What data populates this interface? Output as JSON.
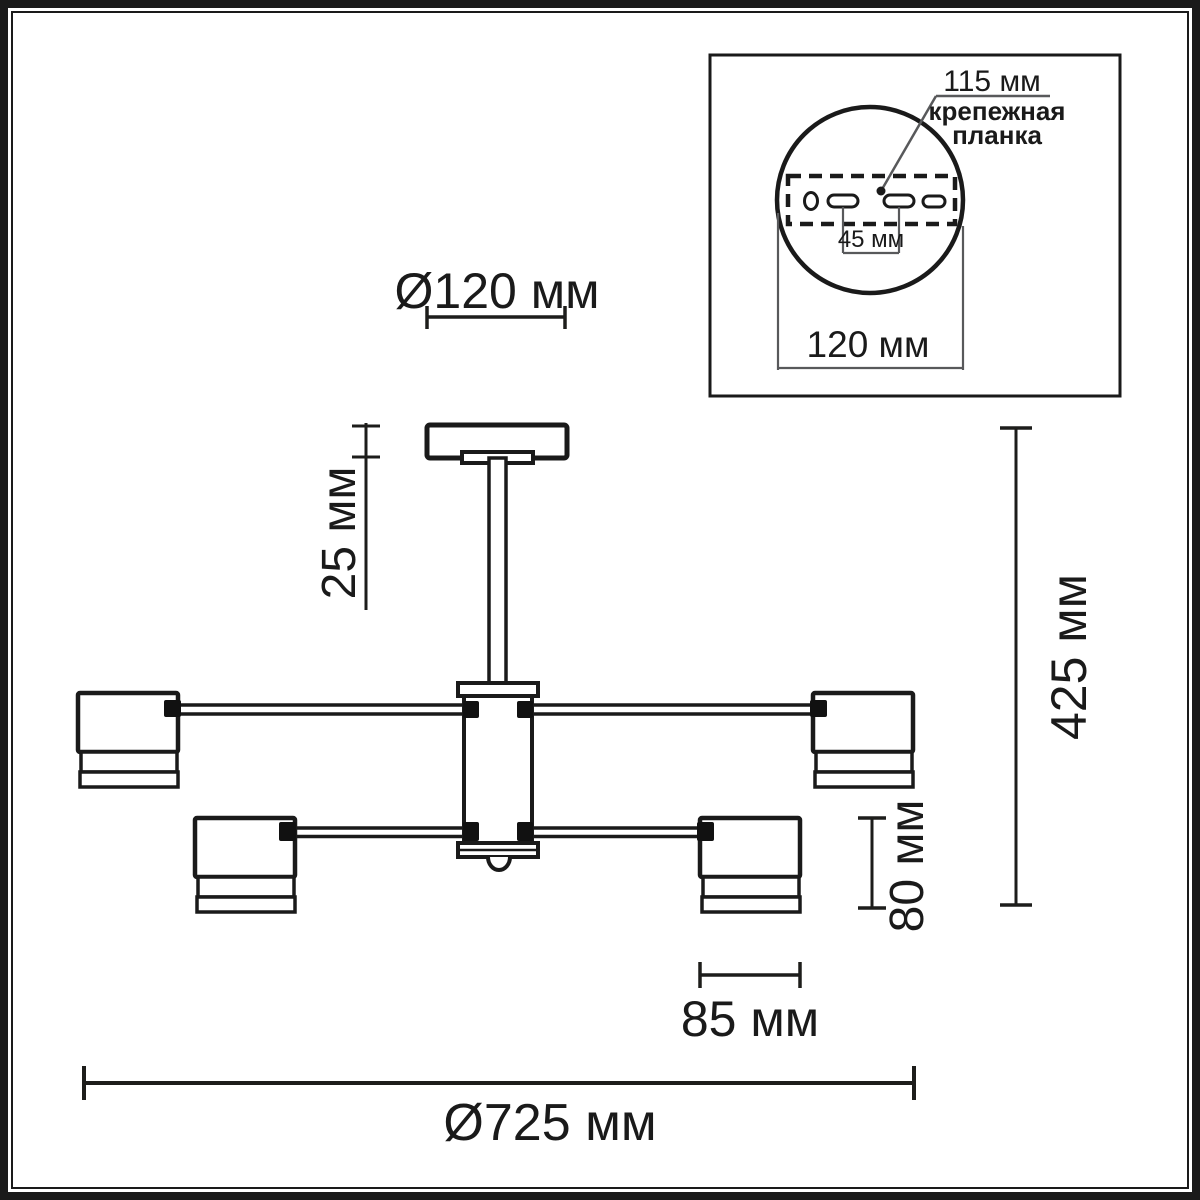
{
  "drawing": {
    "title": "chandelier technical drawing",
    "dimensions": {
      "canopy_diameter": "Ø120 мм",
      "canopy_height": "25 мм",
      "fixture_height": "425 мм",
      "shade_height": "80 мм",
      "shade_diameter": "85 мм",
      "fixture_diameter": "Ø725 мм"
    },
    "inset": {
      "bracket_length": "115 мм",
      "bracket_label_line1": "крепежная",
      "bracket_label_line2": "планка",
      "hole_spacing": "45 мм",
      "base_diameter": "120 мм"
    },
    "colors": {
      "line": "#1a1a1a",
      "dimension_line": "#1d1d1b",
      "thin_line": "#58595b",
      "background": "#ffffff"
    }
  }
}
